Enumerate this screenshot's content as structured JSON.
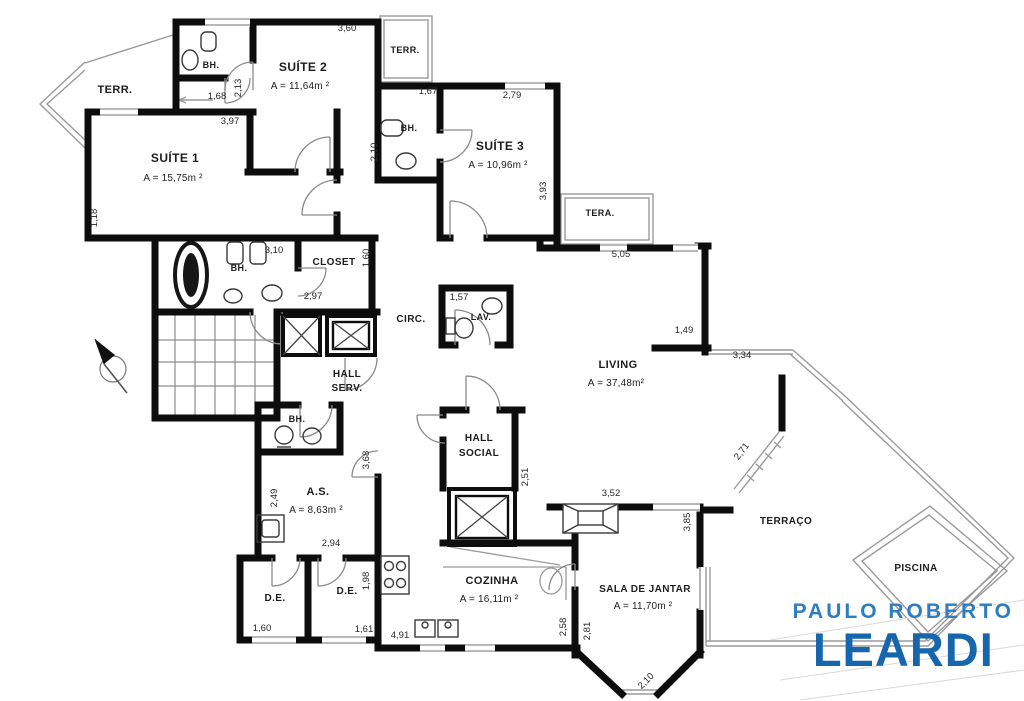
{
  "plan_title": "apartment floor plan",
  "logo": {
    "line1": "PAULO ROBERTO",
    "line2": "LEARDI",
    "color_top": "#2e7dc1",
    "color_bottom": "#1566ac"
  },
  "colors": {
    "walls": "#0d0d0d",
    "thin_lines": "#9a9a9a",
    "doors": "#8a8a8a",
    "text": "#1d1d1d"
  },
  "labels": [
    {
      "id": "terr-left",
      "k": "room",
      "text": "TERR.",
      "x": 115,
      "y": 93,
      "s": 11
    },
    {
      "id": "bh-suite2",
      "k": "room",
      "text": "BH.",
      "x": 211,
      "y": 68,
      "s": 9
    },
    {
      "id": "suite2-name",
      "k": "room",
      "text": "SUÍTE 2",
      "x": 303,
      "y": 71,
      "s": 12
    },
    {
      "id": "suite2-area",
      "k": "area",
      "text": "A = 11,64m ²",
      "x": 300,
      "y": 89,
      "s": 10
    },
    {
      "id": "terr-top",
      "k": "room",
      "text": "TERR.",
      "x": 405,
      "y": 53,
      "s": 9
    },
    {
      "id": "suite1-name",
      "k": "room",
      "text": "SUÍTE 1",
      "x": 175,
      "y": 162,
      "s": 12
    },
    {
      "id": "suite1-area",
      "k": "area",
      "text": "A = 15,75m ²",
      "x": 173,
      "y": 181,
      "s": 10
    },
    {
      "id": "bh-suite3",
      "k": "room",
      "text": "BH.",
      "x": 409,
      "y": 131,
      "s": 9
    },
    {
      "id": "suite3-name",
      "k": "room",
      "text": "SUÍTE 3",
      "x": 500,
      "y": 150,
      "s": 12
    },
    {
      "id": "suite3-area",
      "k": "area",
      "text": "A = 10,96m ²",
      "x": 498,
      "y": 168,
      "s": 10
    },
    {
      "id": "tera-right",
      "k": "room",
      "text": "TERA.",
      "x": 600,
      "y": 216,
      "s": 9
    },
    {
      "id": "bh-main",
      "k": "room",
      "text": "BH.",
      "x": 239,
      "y": 271,
      "s": 9
    },
    {
      "id": "closet",
      "k": "room",
      "text": "CLOSET",
      "x": 334,
      "y": 265,
      "s": 10
    },
    {
      "id": "circ",
      "k": "room",
      "text": "CIRC.",
      "x": 411,
      "y": 322,
      "s": 10
    },
    {
      "id": "lav",
      "k": "room",
      "text": "LAV.",
      "x": 481,
      "y": 320,
      "s": 9
    },
    {
      "id": "hall-serv-line1",
      "k": "room",
      "text": "HALL",
      "x": 347,
      "y": 377,
      "s": 10
    },
    {
      "id": "hall-serv-line2",
      "k": "room",
      "text": "SERV.",
      "x": 347,
      "y": 391,
      "s": 10
    },
    {
      "id": "hall-social-line1",
      "k": "room",
      "text": "HALL",
      "x": 479,
      "y": 441,
      "s": 10
    },
    {
      "id": "hall-social-line2",
      "k": "room",
      "text": "SOCIAL",
      "x": 479,
      "y": 456,
      "s": 10
    },
    {
      "id": "living-name",
      "k": "room",
      "text": "LIVING",
      "x": 618,
      "y": 368,
      "s": 11
    },
    {
      "id": "living-area",
      "k": "area",
      "text": "A = 37,48m²",
      "x": 616,
      "y": 386,
      "s": 10
    },
    {
      "id": "bh-as",
      "k": "room",
      "text": "BH.",
      "x": 297,
      "y": 422,
      "s": 9
    },
    {
      "id": "as-name",
      "k": "room",
      "text": "A.S.",
      "x": 318,
      "y": 495,
      "s": 11
    },
    {
      "id": "as-area",
      "k": "area",
      "text": "A = 8,63m ²",
      "x": 316,
      "y": 513,
      "s": 10
    },
    {
      "id": "de-1",
      "k": "room",
      "text": "D.E.",
      "x": 275,
      "y": 601,
      "s": 10
    },
    {
      "id": "de-2",
      "k": "room",
      "text": "D.E.",
      "x": 347,
      "y": 594,
      "s": 10
    },
    {
      "id": "cozinha-name",
      "k": "room",
      "text": "COZINHA",
      "x": 492,
      "y": 584,
      "s": 11
    },
    {
      "id": "cozinha-area",
      "k": "area",
      "text": "A = 16,11m ²",
      "x": 489,
      "y": 602,
      "s": 10
    },
    {
      "id": "sala-name",
      "k": "room",
      "text": "SALA DE JANTAR",
      "x": 645,
      "y": 592,
      "s": 10
    },
    {
      "id": "sala-area",
      "k": "area",
      "text": "A = 11,70m ²",
      "x": 643,
      "y": 609,
      "s": 10
    },
    {
      "id": "terraco",
      "k": "room",
      "text": "TERRAÇO",
      "x": 786,
      "y": 524,
      "s": 10
    },
    {
      "id": "piscina",
      "k": "room",
      "text": "PISCINA",
      "x": 916,
      "y": 571,
      "s": 10
    },
    {
      "id": "dim-3-60",
      "k": "dim",
      "text": "3,60",
      "x": 347,
      "y": 31,
      "s": 9.5
    },
    {
      "id": "dim-1-68",
      "k": "dim",
      "text": "1,68",
      "x": 217,
      "y": 99,
      "s": 9.5
    },
    {
      "id": "dim-2-13",
      "k": "dim",
      "text": "2,13",
      "x": 241,
      "y": 88,
      "r": -90,
      "s": 9.5
    },
    {
      "id": "dim-3-97",
      "k": "dim",
      "text": "3,97",
      "x": 230,
      "y": 124,
      "s": 9.5
    },
    {
      "id": "dim-1-18",
      "k": "dim",
      "text": "1,18",
      "x": 97,
      "y": 218,
      "r": -90,
      "s": 9.5
    },
    {
      "id": "dim-1-67",
      "k": "dim",
      "text": "1,67",
      "x": 428,
      "y": 94,
      "s": 9.5
    },
    {
      "id": "dim-2-79",
      "k": "dim",
      "text": "2,79",
      "x": 512,
      "y": 98,
      "s": 9.5
    },
    {
      "id": "dim-2-10-bh3",
      "k": "dim",
      "text": "2,10",
      "x": 377,
      "y": 152,
      "r": -90,
      "s": 9.5
    },
    {
      "id": "dim-3-93",
      "k": "dim",
      "text": "3,93",
      "x": 546,
      "y": 191,
      "r": -90,
      "s": 9.5
    },
    {
      "id": "dim-5-05",
      "k": "dim",
      "text": "5,05",
      "x": 621,
      "y": 257,
      "s": 9.5
    },
    {
      "id": "dim-1-49",
      "k": "dim",
      "text": "1,49",
      "x": 684,
      "y": 333,
      "s": 9.5
    },
    {
      "id": "dim-3-34",
      "k": "dim",
      "text": "3,34",
      "x": 742,
      "y": 358,
      "s": 9.5
    },
    {
      "id": "dim-3-10",
      "k": "dim",
      "text": "3,10",
      "x": 274,
      "y": 253,
      "s": 9.5
    },
    {
      "id": "dim-2-97",
      "k": "dim",
      "text": "2,97",
      "x": 313,
      "y": 299,
      "s": 9.5
    },
    {
      "id": "dim-1-60-closet",
      "k": "dim",
      "text": "1,60",
      "x": 369,
      "y": 258,
      "r": -90,
      "s": 9.5
    },
    {
      "id": "dim-1-57",
      "k": "dim",
      "text": "1,57",
      "x": 459,
      "y": 300,
      "s": 9.5
    },
    {
      "id": "dim-2-51",
      "k": "dim",
      "text": "2,51",
      "x": 528,
      "y": 477,
      "r": -90,
      "s": 9.5
    },
    {
      "id": "dim-3-52",
      "k": "dim",
      "text": "3,52",
      "x": 611,
      "y": 496,
      "s": 9.5
    },
    {
      "id": "dim-3-85",
      "k": "dim",
      "text": "3,85",
      "x": 690,
      "y": 522,
      "r": -90,
      "s": 9.5
    },
    {
      "id": "dim-2-71",
      "k": "dim",
      "text": "2,71",
      "x": 744,
      "y": 453,
      "r": -53,
      "s": 9.5
    },
    {
      "id": "dim-2-49",
      "k": "dim",
      "text": "2,49",
      "x": 277,
      "y": 498,
      "r": -90,
      "s": 9.5
    },
    {
      "id": "dim-2-94",
      "k": "dim",
      "text": "2,94",
      "x": 331,
      "y": 546,
      "s": 9.5
    },
    {
      "id": "dim-3-68",
      "k": "dim",
      "text": "3,68",
      "x": 369,
      "y": 460,
      "r": -90,
      "s": 9.5
    },
    {
      "id": "dim-1-98",
      "k": "dim",
      "text": "1,98",
      "x": 369,
      "y": 581,
      "r": -90,
      "s": 9.5
    },
    {
      "id": "dim-1-60-de",
      "k": "dim",
      "text": "1,60",
      "x": 262,
      "y": 631,
      "s": 9.5
    },
    {
      "id": "dim-1-61-de",
      "k": "dim",
      "text": "1,61",
      "x": 364,
      "y": 632,
      "s": 9.5
    },
    {
      "id": "dim-4-91",
      "k": "dim",
      "text": "4,91",
      "x": 400,
      "y": 638,
      "s": 9.5
    },
    {
      "id": "dim-2-58",
      "k": "dim",
      "text": "2,58",
      "x": 566,
      "y": 627,
      "r": -90,
      "s": 9.5
    },
    {
      "id": "dim-2-81",
      "k": "dim",
      "text": "2,81",
      "x": 590,
      "y": 631,
      "r": -90,
      "s": 9.5
    },
    {
      "id": "dim-2-10-sala",
      "k": "dim",
      "text": "2,10",
      "x": 648,
      "y": 683,
      "r": -45,
      "s": 9.5
    }
  ]
}
